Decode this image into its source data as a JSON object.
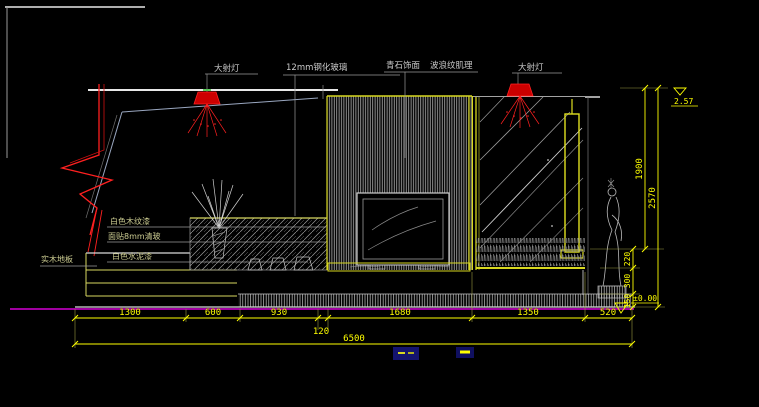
{
  "drawing": {
    "callouts": {
      "spotlight_left": "大射灯",
      "glass_12mm": "12mm钢化玻璃",
      "stone_finish": "青石饰面",
      "wave_texture": "波浪纹肌理",
      "spotlight_right": "大射灯",
      "white_wood_paint": "白色木纹漆",
      "clear_glass_8mm": "面贴8mm清玻",
      "white_cement_paint": "白色水泥漆",
      "solid_wood_floor": "实木地板"
    },
    "dims_bottom": [
      "1300",
      "600",
      "930",
      "1680",
      "1350",
      "520"
    ],
    "dim_offset": "120",
    "dim_total": "6500",
    "dims_right_inner": [
      "150",
      "300",
      "220"
    ],
    "dim_right_1900": "1900",
    "dim_right_2570": "2570",
    "level_top": "2.57",
    "level_floor": "±0.00",
    "colors": {
      "background": "#000000",
      "dimension": "#ffff00",
      "outline": "#d9d9d9",
      "lamp_red": "#ff2020",
      "floor_magenta": "#ff00ff"
    }
  }
}
